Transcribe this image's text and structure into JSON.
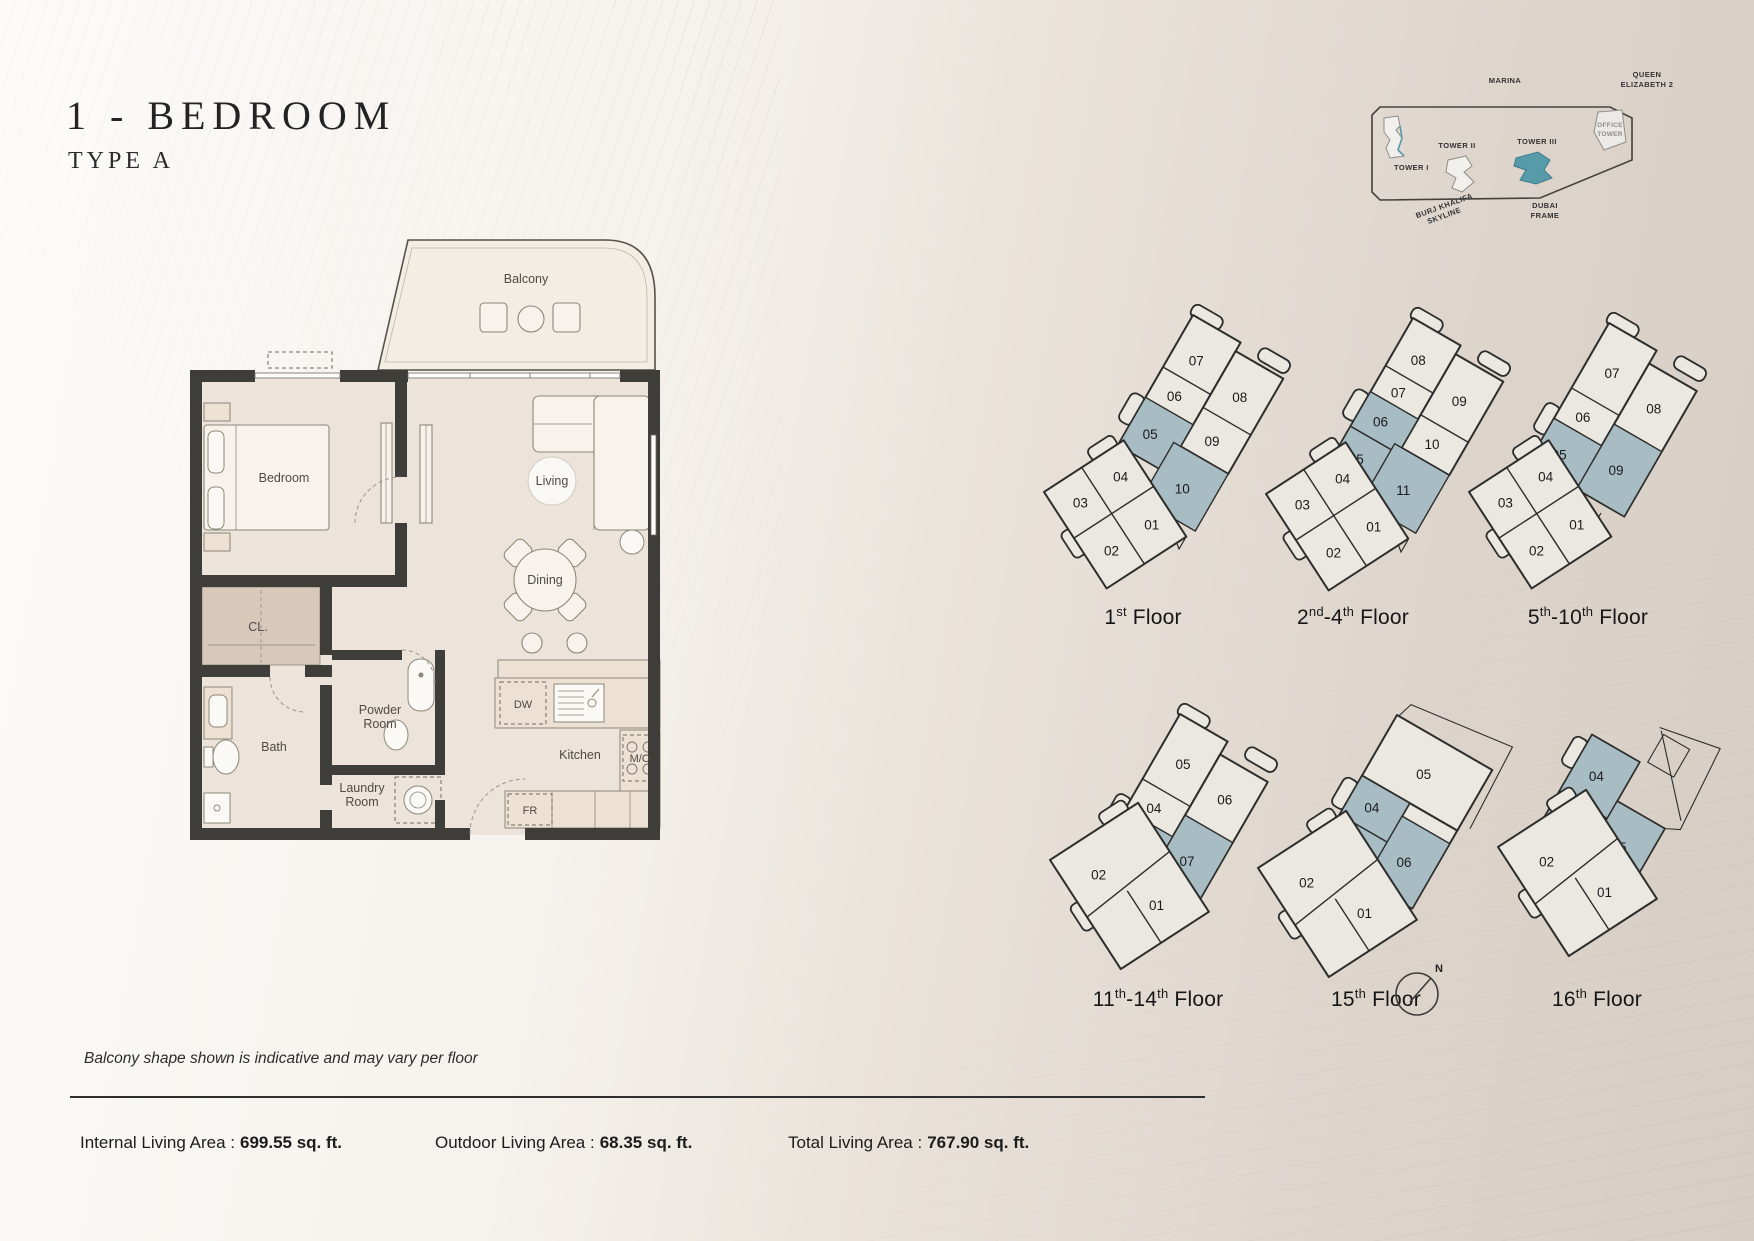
{
  "page": {
    "title": "1 - BEDROOM",
    "subtitle": "TYPE A",
    "note": "Balcony shape shown is indicative and may vary per floor"
  },
  "site_map": {
    "marina": "MARINA",
    "queen_line1": "QUEEN",
    "queen_line2": "ELIZABETH 2",
    "tower1": "TOWER I",
    "tower2": "TOWER II",
    "tower3": "TOWER III",
    "office_line1": "OFFICE",
    "office_line2": "TOWER",
    "burj_line1": "BURJ KHALIFA",
    "burj_line2": "SKYLINE",
    "dubai_line1": "DUBAI",
    "dubai_line2": "FRAME",
    "highlighted_tower": "TOWER III"
  },
  "floor_plan": {
    "balcony": "Balcony",
    "bedroom": "Bedroom",
    "living": "Living",
    "dining": "Dining",
    "closet": "CL.",
    "powder_line1": "Powder",
    "powder_line2": "Room",
    "bath": "Bath",
    "laundry_line1": "Laundry",
    "laundry_line2": "Room",
    "kitchen": "Kitchen",
    "dishwasher": "DW",
    "microwave_oven": "M/O",
    "fridge": "FR"
  },
  "floorplates": [
    {
      "name": "1st Floor",
      "label": {
        "b1": "1",
        "s1": "st",
        "b2": " Floor",
        "s2": "",
        "b3": ""
      },
      "units": {
        "u1": "07",
        "u2": "06",
        "u3": "05",
        "u4": "08",
        "u5": "09",
        "u6": "10",
        "l1": "04",
        "l2": "03",
        "l3": "01",
        "l4": "02"
      },
      "highlighted": [
        "05",
        "10"
      ]
    },
    {
      "name": "2nd-4th Floor",
      "label": {
        "b1": "2",
        "s1": "nd",
        "b2": "-4",
        "s2": "th",
        "b3": " Floor"
      },
      "units": {
        "u1": "08",
        "u2": "07",
        "u3": "06",
        "u4": "05",
        "u5": "09",
        "u6": "10",
        "u7": "11",
        "l1": "04",
        "l2": "03",
        "l3": "01",
        "l4": "02"
      },
      "highlighted": [
        "05",
        "06",
        "11"
      ]
    },
    {
      "name": "5th-10th Floor",
      "label": {
        "b1": "5",
        "s1": "th",
        "b2": "-10",
        "s2": "th",
        "b3": " Floor"
      },
      "units": {
        "u1": "07",
        "u2": "06",
        "u3": "05",
        "u4": "08",
        "u5": "09",
        "l1": "04",
        "l2": "03",
        "l3": "01",
        "l4": "02"
      },
      "highlighted": [
        "05",
        "09"
      ]
    },
    {
      "name": "11th-14th Floor",
      "label": {
        "b1": "11",
        "s1": "th",
        "b2": "-14",
        "s2": "th",
        "b3": " Floor"
      },
      "units": {
        "u1": "05",
        "u2": "04",
        "u3": "03",
        "u4": "06",
        "u5": "07",
        "l1": "02",
        "l2": "01"
      },
      "highlighted": [
        "03",
        "07"
      ]
    },
    {
      "name": "15th Floor",
      "label": {
        "b1": "15",
        "s1": "th",
        "b2": " Floor",
        "s2": "",
        "b3": ""
      },
      "units": {
        "u1": "05",
        "u2": "04",
        "u3": "03",
        "u4": "06",
        "l1": "02",
        "l2": "01"
      },
      "highlighted": [
        "03",
        "04",
        "06"
      ]
    },
    {
      "name": "16th Floor",
      "label": {
        "b1": "16",
        "s1": "th",
        "b2": " Floor",
        "s2": "",
        "b3": ""
      },
      "units": {
        "u1": "04",
        "u2": "03",
        "u3": "05",
        "l1": "02",
        "l2": "01"
      },
      "highlighted": [
        "03",
        "04",
        "05"
      ]
    }
  ],
  "stats": [
    {
      "label": "Internal Living Area :",
      "value": "699.55 sq. ft."
    },
    {
      "label": "Outdoor Living Area :",
      "value": "68.35 sq. ft."
    },
    {
      "label": "Total Living Area :",
      "value": "767.90 sq. ft."
    }
  ],
  "compass": {
    "n": "N"
  },
  "colors": {
    "unit_highlight": "#a7bcc3",
    "tower_highlight": "#579aa9",
    "wall": "#3f3d39",
    "page_background": "#e7e0d8"
  }
}
